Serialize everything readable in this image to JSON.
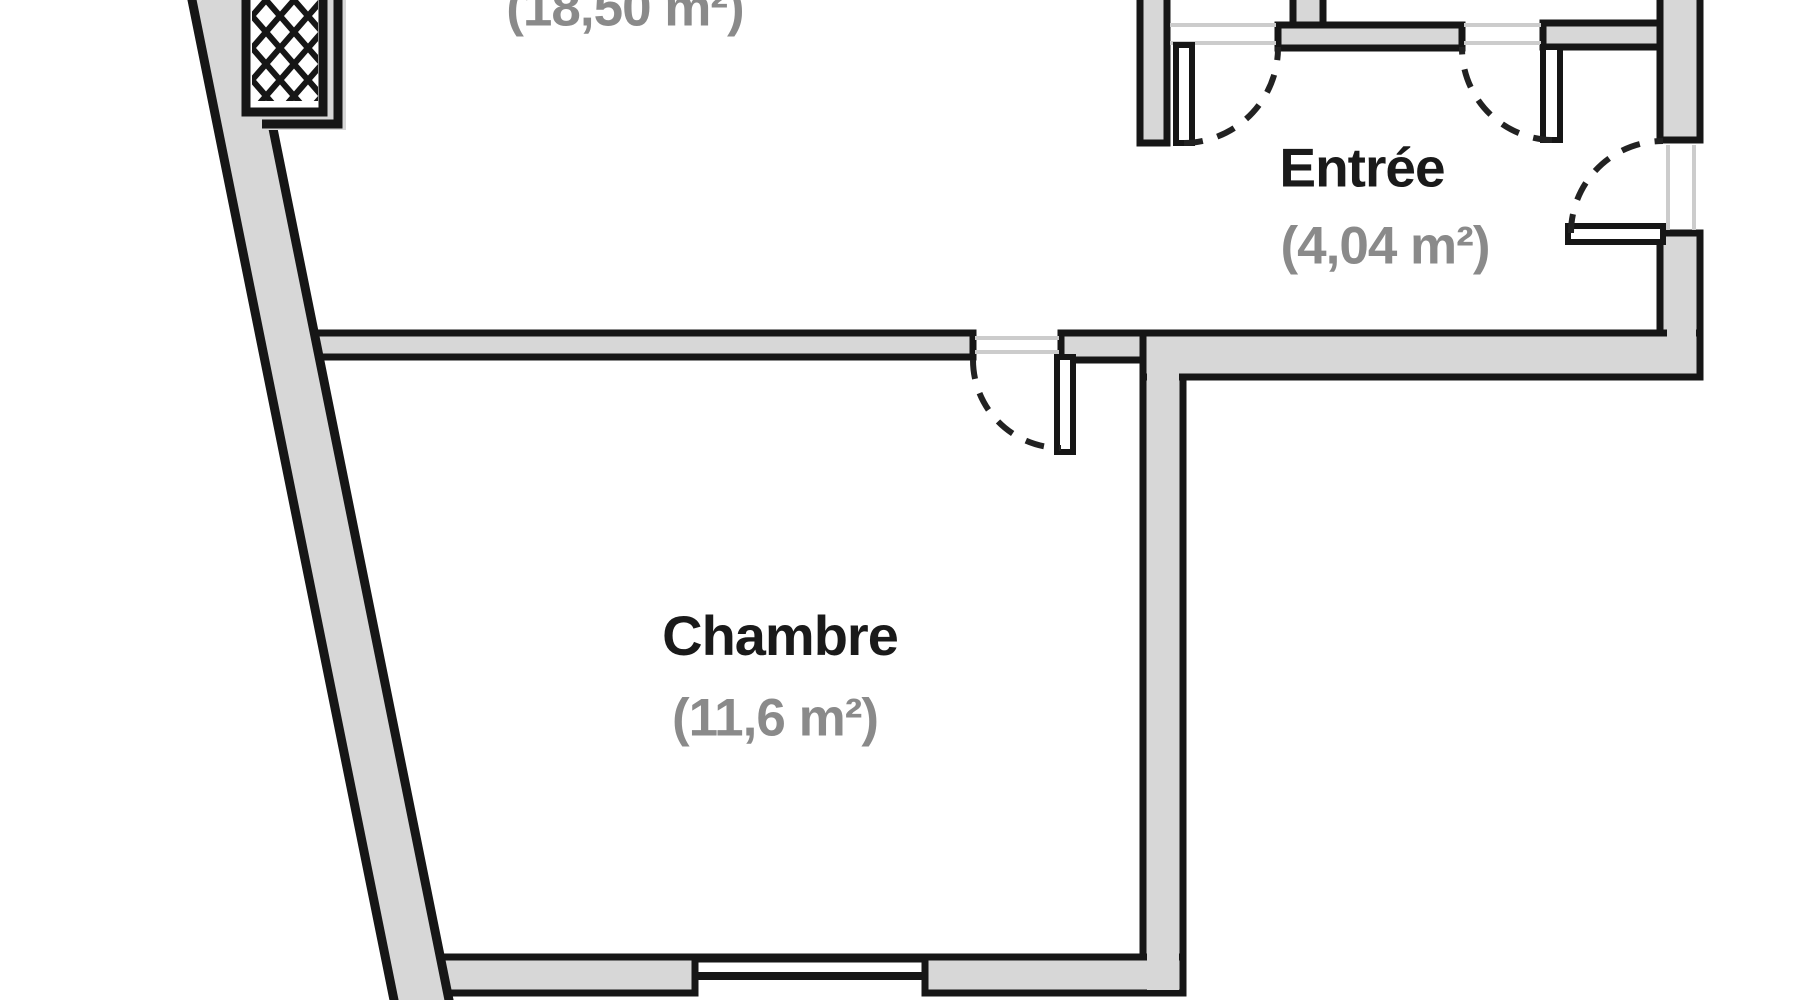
{
  "plan": {
    "type": "apartment-floor-plan",
    "rooms": {
      "upper_room_partial": {
        "name": "",
        "area_label": "(18,50 m²)"
      },
      "entree": {
        "name": "Entrée",
        "area_label": "(4,04 m²)"
      },
      "chambre": {
        "name": "Chambre",
        "area_label": "(11,6 m²)"
      }
    },
    "colors": {
      "wall_fill": "#d7d7d7",
      "wall_line": "#161616",
      "room_name_text": "#1a1a1a",
      "area_text": "#8a8a8a",
      "opening_line": "#cccccc",
      "background": "#ffffff"
    }
  }
}
